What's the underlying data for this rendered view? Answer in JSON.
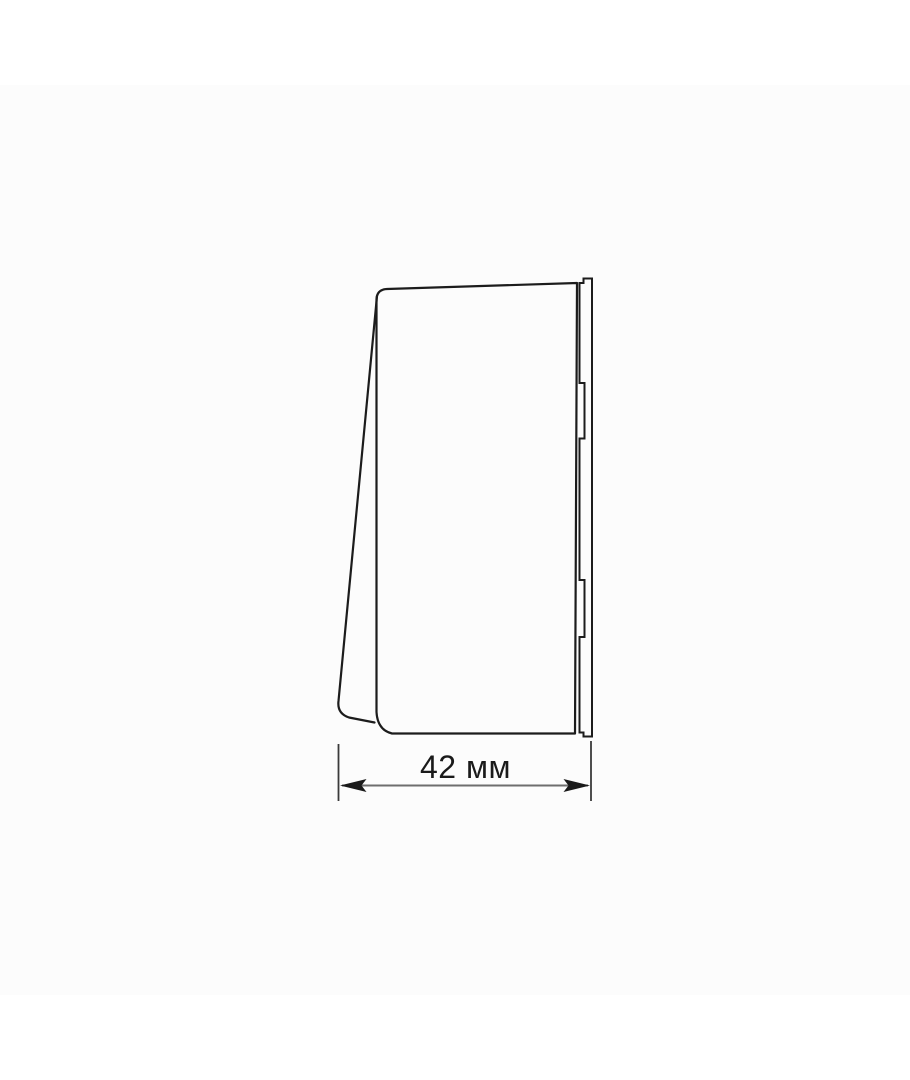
{
  "page": {
    "background_color": "#ffffff",
    "image_band_color": "#fcfcfc"
  },
  "drawing": {
    "type": "technical-line-drawing",
    "subject": "wall-switch-side-profile-view",
    "outline_color": "#1c1c1c",
    "dimension_line_color": "#6e6e6e",
    "extension_line_color": "#3a3a3a",
    "dimension": {
      "label": "42 мм",
      "value": 42,
      "unit": "мм"
    }
  }
}
